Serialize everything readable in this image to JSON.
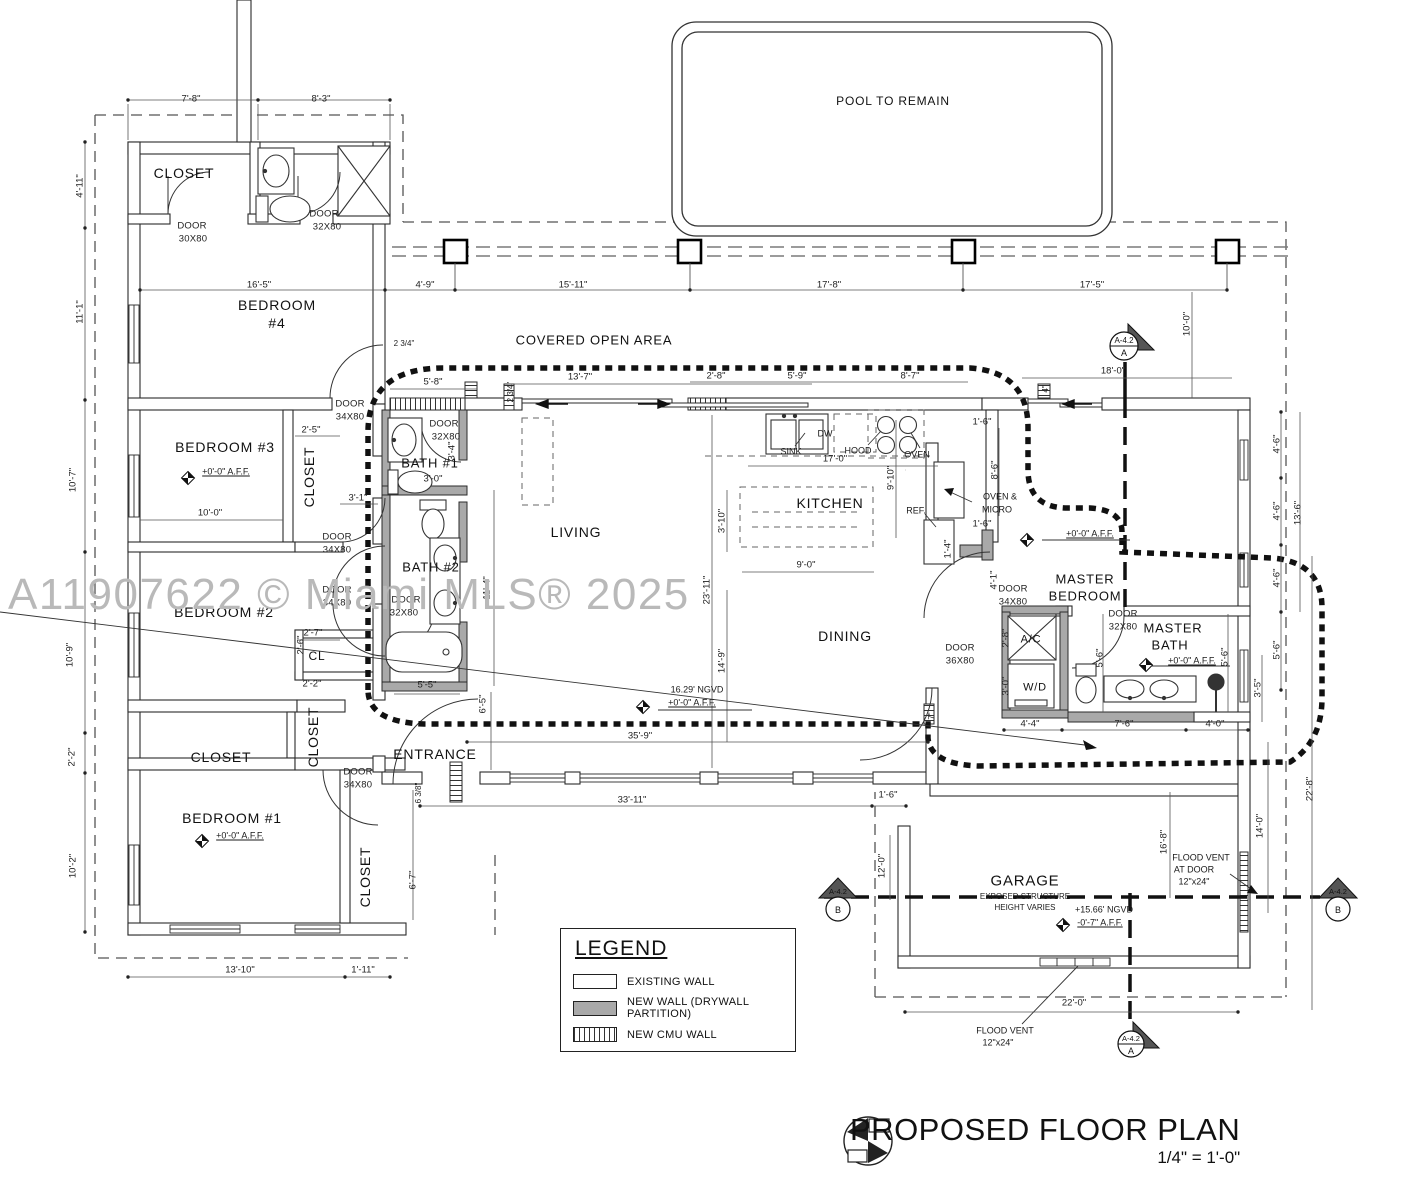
{
  "watermark": "A11907622 © Miami MLS® 2025",
  "plan_title": {
    "main": "PROPOSED FLOOR PLAN",
    "scale": "1/4\" = 1'-0\""
  },
  "legend": {
    "title": "LEGEND",
    "items": [
      {
        "label": "EXISTING WALL",
        "swatch": "existing"
      },
      {
        "label": "NEW WALL (DRYWALL PARTITION)",
        "swatch": "new-drywall"
      },
      {
        "label": "NEW CMU WALL",
        "swatch": "new-cmu"
      }
    ]
  },
  "markers": [
    {
      "sheet": "A-4.2",
      "id": "A"
    },
    {
      "sheet": "A-4.2",
      "id": "B"
    },
    {
      "sheet": "A-4.2",
      "id": "B"
    },
    {
      "sheet": "A-4.2",
      "id": "A"
    }
  ],
  "colors": {
    "line": "#222222",
    "new_wall": "#a9a9a9",
    "watermark": "#b9b9b9"
  },
  "labels": [
    {
      "t": "CLOSET",
      "x": 184,
      "y": 173,
      "k": "room"
    },
    {
      "t": "BEDROOM",
      "x": 277,
      "y": 305,
      "k": "room"
    },
    {
      "t": "#4",
      "x": 277,
      "y": 323,
      "k": "room"
    },
    {
      "t": "BEDROOM #3",
      "x": 225,
      "y": 447,
      "k": "room"
    },
    {
      "t": "BEDROOM #2",
      "x": 224,
      "y": 612,
      "k": "room"
    },
    {
      "t": "BEDROOM #1",
      "x": 232,
      "y": 818,
      "k": "room"
    },
    {
      "t": "CLOSET",
      "x": 309,
      "y": 477,
      "k": "room",
      "rot": 1
    },
    {
      "t": "CL",
      "x": 317,
      "y": 656,
      "k": "room",
      "s": 12
    },
    {
      "t": "CLOSET",
      "x": 221,
      "y": 757,
      "k": "room"
    },
    {
      "t": "CLOSET",
      "x": 313,
      "y": 737,
      "k": "room",
      "rot": 1
    },
    {
      "t": "CLOSET",
      "x": 365,
      "y": 877,
      "k": "room",
      "rot": 1
    },
    {
      "t": "BATH #1",
      "x": 430,
      "y": 463,
      "k": "room",
      "s": 13
    },
    {
      "t": "BATH #2",
      "x": 431,
      "y": 567,
      "k": "room",
      "s": 13
    },
    {
      "t": "LIVING",
      "x": 576,
      "y": 532,
      "k": "room"
    },
    {
      "t": "KITCHEN",
      "x": 830,
      "y": 503,
      "k": "room"
    },
    {
      "t": "DINING",
      "x": 845,
      "y": 636,
      "k": "room"
    },
    {
      "t": "ENTRANCE",
      "x": 435,
      "y": 754,
      "k": "room"
    },
    {
      "t": "MASTER",
      "x": 1085,
      "y": 579,
      "k": "room",
      "s": 13
    },
    {
      "t": "BEDROOM",
      "x": 1085,
      "y": 596,
      "k": "room",
      "s": 13
    },
    {
      "t": "MASTER",
      "x": 1173,
      "y": 628,
      "k": "room",
      "s": 13
    },
    {
      "t": "BATH",
      "x": 1170,
      "y": 645,
      "k": "room",
      "s": 13
    },
    {
      "t": "GARAGE",
      "x": 1025,
      "y": 881,
      "k": "room",
      "s": 15
    },
    {
      "t": "A/C",
      "x": 1031,
      "y": 640,
      "k": "room",
      "s": 11
    },
    {
      "t": "W/D",
      "x": 1035,
      "y": 688,
      "k": "room",
      "s": 11
    },
    {
      "t": "POOL TO REMAIN",
      "x": 893,
      "y": 101,
      "k": "room",
      "s": 12
    },
    {
      "t": "COVERED OPEN AREA",
      "x": 594,
      "y": 340,
      "k": "room",
      "s": 13
    },
    {
      "t": "DOOR",
      "x": 192,
      "y": 226,
      "k": "door"
    },
    {
      "t": "30X80",
      "x": 193,
      "y": 239,
      "k": "door"
    },
    {
      "t": "DOOR",
      "x": 324,
      "y": 214,
      "k": "door"
    },
    {
      "t": "32X80",
      "x": 327,
      "y": 227,
      "k": "door"
    },
    {
      "t": "DOOR",
      "x": 350,
      "y": 404,
      "k": "door"
    },
    {
      "t": "34X80",
      "x": 350,
      "y": 417,
      "k": "door"
    },
    {
      "t": "DOOR",
      "x": 444,
      "y": 424,
      "k": "door"
    },
    {
      "t": "32X80",
      "x": 446,
      "y": 437,
      "k": "door"
    },
    {
      "t": "DOOR",
      "x": 337,
      "y": 537,
      "k": "door"
    },
    {
      "t": "34X80",
      "x": 337,
      "y": 550,
      "k": "door"
    },
    {
      "t": "DOOR",
      "x": 337,
      "y": 590,
      "k": "door"
    },
    {
      "t": "34X80",
      "x": 337,
      "y": 603,
      "k": "door"
    },
    {
      "t": "DOOR",
      "x": 406,
      "y": 600,
      "k": "door"
    },
    {
      "t": "32X80",
      "x": 404,
      "y": 613,
      "k": "door"
    },
    {
      "t": "DOOR",
      "x": 358,
      "y": 772,
      "k": "door"
    },
    {
      "t": "34X80",
      "x": 358,
      "y": 785,
      "k": "door"
    },
    {
      "t": "DOOR",
      "x": 960,
      "y": 648,
      "k": "door"
    },
    {
      "t": "36X80",
      "x": 960,
      "y": 661,
      "k": "door"
    },
    {
      "t": "DOOR",
      "x": 1013,
      "y": 589,
      "k": "door"
    },
    {
      "t": "34X80",
      "x": 1013,
      "y": 602,
      "k": "door"
    },
    {
      "t": "DOOR",
      "x": 1123,
      "y": 614,
      "k": "door"
    },
    {
      "t": "32X80",
      "x": 1123,
      "y": 627,
      "k": "door"
    },
    {
      "t": "+0'-0\" A.F.F.",
      "x": 226,
      "y": 472,
      "k": "note",
      "u": 1
    },
    {
      "t": "+0'-0\" A.F.F.",
      "x": 240,
      "y": 836,
      "k": "note",
      "u": 1
    },
    {
      "t": "16.29' NGVD",
      "x": 697,
      "y": 690,
      "k": "note"
    },
    {
      "t": "+0'-0\" A.F.F.",
      "x": 692,
      "y": 703,
      "k": "note",
      "u": 1
    },
    {
      "t": "+0'-0\" A.F.F.",
      "x": 1090,
      "y": 534,
      "k": "note",
      "u": 1
    },
    {
      "t": "+0'-0\" A.F.F.",
      "x": 1192,
      "y": 661,
      "k": "note",
      "u": 1
    },
    {
      "t": "+15.66' NGVD",
      "x": 1104,
      "y": 910,
      "k": "note"
    },
    {
      "t": "-0'-7\" A.F.F.",
      "x": 1100,
      "y": 923,
      "k": "note",
      "u": 1
    },
    {
      "t": "EXPOSED STRUCTURE",
      "x": 1025,
      "y": 897,
      "k": "note",
      "s": 8
    },
    {
      "t": "HEIGHT VARIES",
      "x": 1025,
      "y": 908,
      "k": "note",
      "s": 8
    },
    {
      "t": "FLOOD VENT",
      "x": 1201,
      "y": 858,
      "k": "note"
    },
    {
      "t": "AT DOOR",
      "x": 1194,
      "y": 870,
      "k": "note"
    },
    {
      "t": "12\"x24\"",
      "x": 1194,
      "y": 882,
      "k": "note"
    },
    {
      "t": "FLOOD VENT",
      "x": 1005,
      "y": 1031,
      "k": "note"
    },
    {
      "t": "12\"x24\"",
      "x": 998,
      "y": 1043,
      "k": "note"
    },
    {
      "t": "SINK",
      "x": 791,
      "y": 452,
      "k": "note"
    },
    {
      "t": "DW",
      "x": 825,
      "y": 434,
      "k": "note"
    },
    {
      "t": "HOOD",
      "x": 858,
      "y": 451,
      "k": "note"
    },
    {
      "t": "OVEN",
      "x": 917,
      "y": 455,
      "k": "note"
    },
    {
      "t": "REF.",
      "x": 916,
      "y": 511,
      "k": "note"
    },
    {
      "t": "OVEN &",
      "x": 1000,
      "y": 497,
      "k": "note"
    },
    {
      "t": "MICRO",
      "x": 997,
      "y": 510,
      "k": "note"
    },
    {
      "t": "7'-8\"",
      "x": 191,
      "y": 99,
      "k": "dim"
    },
    {
      "t": "8'-3\"",
      "x": 321,
      "y": 99,
      "k": "dim"
    },
    {
      "t": "4'-11\"",
      "x": 80,
      "y": 186,
      "k": "dim",
      "rot": 1
    },
    {
      "t": "11'-1\"",
      "x": 80,
      "y": 312,
      "k": "dim",
      "rot": 1
    },
    {
      "t": "10'-7\"",
      "x": 73,
      "y": 480,
      "k": "dim",
      "rot": 1
    },
    {
      "t": "10'-9\"",
      "x": 70,
      "y": 655,
      "k": "dim",
      "rot": 1
    },
    {
      "t": "2'-2\"",
      "x": 72,
      "y": 757,
      "k": "dim",
      "rot": 1
    },
    {
      "t": "10'-2\"",
      "x": 73,
      "y": 866,
      "k": "dim",
      "rot": 1
    },
    {
      "t": "16'-5\"",
      "x": 259,
      "y": 285,
      "k": "dim"
    },
    {
      "t": "4'-9\"",
      "x": 425,
      "y": 285,
      "k": "dim"
    },
    {
      "t": "15'-11\"",
      "x": 573,
      "y": 285,
      "k": "dim"
    },
    {
      "t": "17'-8\"",
      "x": 829,
      "y": 285,
      "k": "dim"
    },
    {
      "t": "17'-5\"",
      "x": 1092,
      "y": 285,
      "k": "dim"
    },
    {
      "t": "10'-0\"",
      "x": 1187,
      "y": 324,
      "k": "dim",
      "rot": 1
    },
    {
      "t": "18'-0\"",
      "x": 1113,
      "y": 371,
      "k": "dim"
    },
    {
      "t": "5'-8\"",
      "x": 433,
      "y": 382,
      "k": "dim"
    },
    {
      "t": "13'-7\"",
      "x": 580,
      "y": 377,
      "k": "dim"
    },
    {
      "t": "2'-8\"",
      "x": 716,
      "y": 376,
      "k": "dim"
    },
    {
      "t": "5'-9\"",
      "x": 797,
      "y": 376,
      "k": "dim"
    },
    {
      "t": "8'-7\"",
      "x": 910,
      "y": 376,
      "k": "dim"
    },
    {
      "t": "2 3/4\"",
      "x": 404,
      "y": 344,
      "k": "dim",
      "s": 8
    },
    {
      "t": "2 3/4\"",
      "x": 511,
      "y": 392,
      "k": "dim",
      "rot": 1,
      "s": 8
    },
    {
      "t": "4\"",
      "x": 1046,
      "y": 389,
      "k": "dim",
      "rot": 1,
      "s": 8
    },
    {
      "t": "1'-6\"",
      "x": 982,
      "y": 422,
      "k": "dim"
    },
    {
      "t": "8'-6\"",
      "x": 995,
      "y": 470,
      "k": "dim",
      "rot": 1
    },
    {
      "t": "17'-0\"",
      "x": 835,
      "y": 459,
      "k": "dim"
    },
    {
      "t": "9'-10\"",
      "x": 891,
      "y": 478,
      "k": "dim",
      "rot": 1
    },
    {
      "t": "1'-6\"",
      "x": 982,
      "y": 524,
      "k": "dim"
    },
    {
      "t": "1'-4\"",
      "x": 948,
      "y": 549,
      "k": "dim",
      "rot": 1
    },
    {
      "t": "3'-10\"",
      "x": 722,
      "y": 521,
      "k": "dim",
      "rot": 1
    },
    {
      "t": "9'-0\"",
      "x": 806,
      "y": 565,
      "k": "dim"
    },
    {
      "t": "23'-11\"",
      "x": 707,
      "y": 590,
      "k": "dim",
      "rot": 1
    },
    {
      "t": "14'-9\"",
      "x": 722,
      "y": 661,
      "k": "dim",
      "rot": 1
    },
    {
      "t": "4'-1\"",
      "x": 994,
      "y": 580,
      "k": "dim",
      "rot": 1
    },
    {
      "t": "2'-8\"",
      "x": 1006,
      "y": 638,
      "k": "dim",
      "rot": 1
    },
    {
      "t": "3'-0\"",
      "x": 1006,
      "y": 686,
      "k": "dim",
      "rot": 1
    },
    {
      "t": "2'-5\"",
      "x": 311,
      "y": 430,
      "k": "dim"
    },
    {
      "t": "3'-1\"",
      "x": 358,
      "y": 498,
      "k": "dim"
    },
    {
      "t": "10'-0\"",
      "x": 210,
      "y": 513,
      "k": "dim"
    },
    {
      "t": "2'-7\"",
      "x": 313,
      "y": 633,
      "k": "dim"
    },
    {
      "t": "2'-6\"",
      "x": 301,
      "y": 645,
      "k": "dim",
      "rot": 1
    },
    {
      "t": "2'-2\"",
      "x": 312,
      "y": 684,
      "k": "dim"
    },
    {
      "t": "3'-0\"",
      "x": 433,
      "y": 479,
      "k": "dim"
    },
    {
      "t": "3'-4\"",
      "x": 452,
      "y": 451,
      "k": "dim",
      "rot": 1
    },
    {
      "t": "11'-4\"",
      "x": 487,
      "y": 588,
      "k": "dim",
      "rot": 1
    },
    {
      "t": "5'-5\"",
      "x": 427,
      "y": 685,
      "k": "dim"
    },
    {
      "t": "6'-5\"",
      "x": 483,
      "y": 704,
      "k": "dim",
      "rot": 1
    },
    {
      "t": "6 3/8\"",
      "x": 419,
      "y": 793,
      "k": "dim",
      "rot": 1,
      "s": 8
    },
    {
      "t": "6'-7\"",
      "x": 413,
      "y": 880,
      "k": "dim",
      "rot": 1
    },
    {
      "t": "13'-10\"",
      "x": 240,
      "y": 970,
      "k": "dim"
    },
    {
      "t": "1'-11\"",
      "x": 363,
      "y": 970,
      "k": "dim"
    },
    {
      "t": "33'-11\"",
      "x": 632,
      "y": 800,
      "k": "dim"
    },
    {
      "t": "1'-6\"",
      "x": 888,
      "y": 795,
      "k": "dim"
    },
    {
      "t": "35'-9\"",
      "x": 640,
      "y": 736,
      "k": "dim"
    },
    {
      "t": "4'-6\"",
      "x": 1277,
      "y": 444,
      "k": "dim",
      "rot": 1
    },
    {
      "t": "4'-6\"",
      "x": 1277,
      "y": 511,
      "k": "dim",
      "rot": 1
    },
    {
      "t": "4'-6\"",
      "x": 1277,
      "y": 578,
      "k": "dim",
      "rot": 1
    },
    {
      "t": "5'-6\"",
      "x": 1277,
      "y": 650,
      "k": "dim",
      "rot": 1
    },
    {
      "t": "3'-5\"",
      "x": 1258,
      "y": 688,
      "k": "dim",
      "rot": 1
    },
    {
      "t": "13'-6\"",
      "x": 1298,
      "y": 513,
      "k": "dim",
      "rot": 1
    },
    {
      "t": "22'-8\"",
      "x": 1310,
      "y": 789,
      "k": "dim",
      "rot": 1
    },
    {
      "t": "5'-6\"",
      "x": 1100,
      "y": 658,
      "k": "dim",
      "rot": 1
    },
    {
      "t": "5'-6\"",
      "x": 1225,
      "y": 657,
      "k": "dim",
      "rot": 1
    },
    {
      "t": "4'-4\"",
      "x": 1030,
      "y": 724,
      "k": "dim"
    },
    {
      "t": "7'-6\"",
      "x": 1124,
      "y": 724,
      "k": "dim"
    },
    {
      "t": "4'-0\"",
      "x": 1215,
      "y": 724,
      "k": "dim"
    },
    {
      "t": "12'-0\"",
      "x": 882,
      "y": 866,
      "k": "dim",
      "rot": 1
    },
    {
      "t": "16'-8\"",
      "x": 1164,
      "y": 842,
      "k": "dim",
      "rot": 1
    },
    {
      "t": "14'-0\"",
      "x": 1260,
      "y": 826,
      "k": "dim",
      "rot": 1
    },
    {
      "t": "22'-0\"",
      "x": 1074,
      "y": 1003,
      "k": "dim"
    },
    {
      "t": "7\"",
      "x": 932,
      "y": 716,
      "k": "dim",
      "rot": 1,
      "s": 8
    }
  ]
}
